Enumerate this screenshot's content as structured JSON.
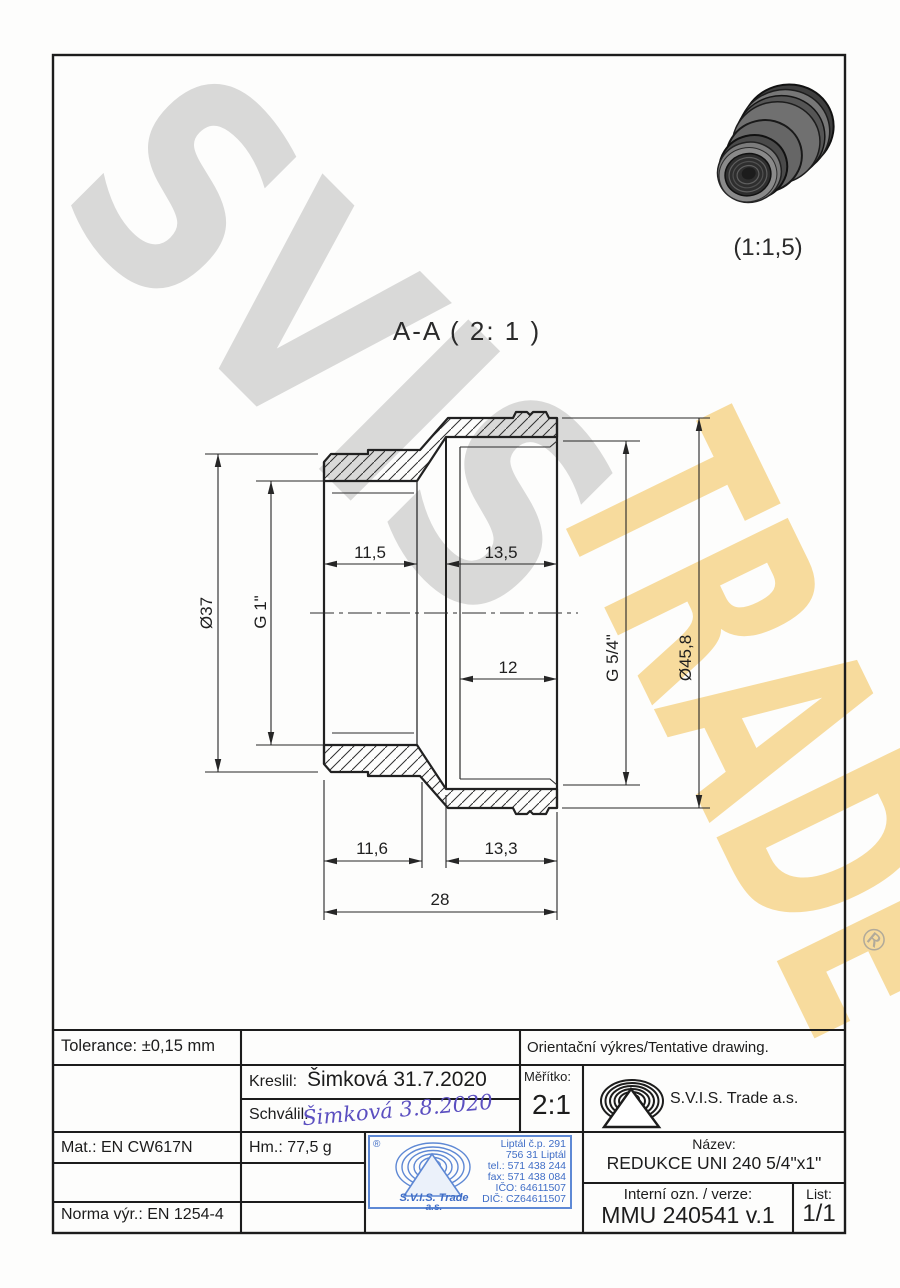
{
  "watermark": {
    "word1": "SVIS",
    "word2": "TRADE",
    "registered": "®",
    "gray_color": "#d8d8d8",
    "gold_color": "#f2c35d"
  },
  "view3d": {
    "scale_label": "(1:1,5)"
  },
  "section": {
    "title": "A-A ( 2: 1 )"
  },
  "dims": {
    "top_left": "11,5",
    "top_right": "13,5",
    "mid_right": "12",
    "bottom_left": "11,6",
    "bottom_right": "13,3",
    "overall": "28",
    "dia_small": "Ø37",
    "thread_small": "G 1\"",
    "thread_large": "G 5/4\"",
    "dia_large": "Ø45,8"
  },
  "titleblock": {
    "tolerance": "Tolerance: ±0,15 mm",
    "note": "Orientační výkres/Tentative drawing.",
    "kreslil_label": "Kreslil:",
    "kreslil_value": "Šimková 31.7.2020",
    "schvalil_label": "Schválil:",
    "schvalil_value": "Šimková 3.8.2020",
    "meritko_label": "Měřítko:",
    "meritko_value": "2:1",
    "company": "S.V.I.S. Trade a.s.",
    "mat": "Mat.: EN CW617N",
    "hm": "Hm.: 77,5 g",
    "norma": "Norma výr.: EN 1254-4",
    "nazev_label": "Název:",
    "nazev_value": "REDUKCE UNI 240 5/4\"x1\"",
    "interni_label": "Interní ozn. / verze:",
    "interni_value": "MMU 240541 v.1",
    "list_label": "List:",
    "list_value": "1/1"
  },
  "stamp": {
    "registered": "®",
    "address1": "Liptál č.p. 291",
    "address2": "756 31 Liptál",
    "tel": "tel.: 571 438 244",
    "fax": "fax: 571 438 084",
    "ico": "IČO: 64611507",
    "dic": "DIČ: CZ64611507",
    "company_line1": "S.V.I.S. Trade",
    "company_line2": "a.s.",
    "ink_color": "#3f6dc6"
  }
}
